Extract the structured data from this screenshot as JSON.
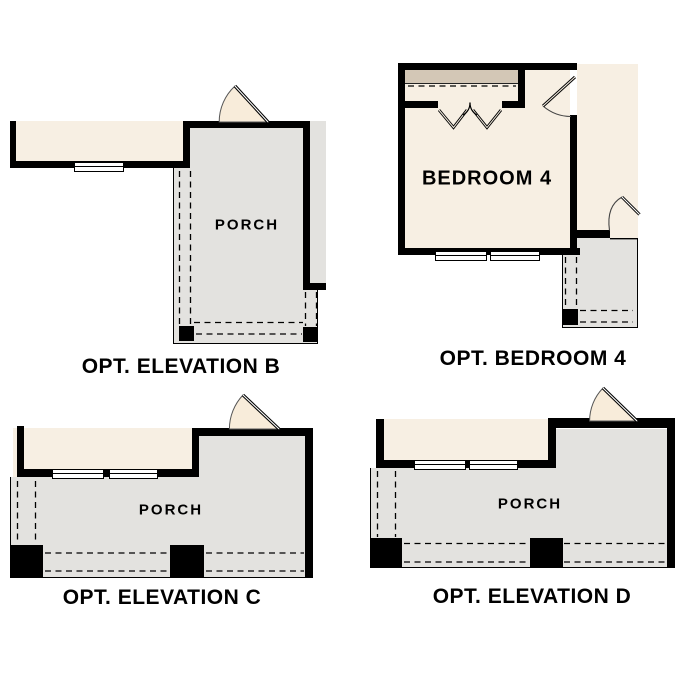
{
  "sheet": {
    "type": "floor-plan-options-sheet",
    "background": "#ffffff"
  },
  "colors": {
    "wall": "#000000",
    "interior_cream": "#f7efe3",
    "porch_gray": "#e3e2df",
    "closet_tan": "#d3c7b6",
    "door_wedge": "#f8ecda",
    "text": "#000000"
  },
  "plans": {
    "elevation_b": {
      "caption": "OPT. ELEVATION B",
      "porch_label": "PORCH"
    },
    "bedroom_4": {
      "caption": "OPT. BEDROOM 4",
      "room_label": "BEDROOM 4"
    },
    "elevation_c": {
      "caption": "OPT. ELEVATION C",
      "porch_label": "PORCH"
    },
    "elevation_d": {
      "caption": "OPT. ELEVATION D",
      "porch_label": "PORCH"
    }
  }
}
